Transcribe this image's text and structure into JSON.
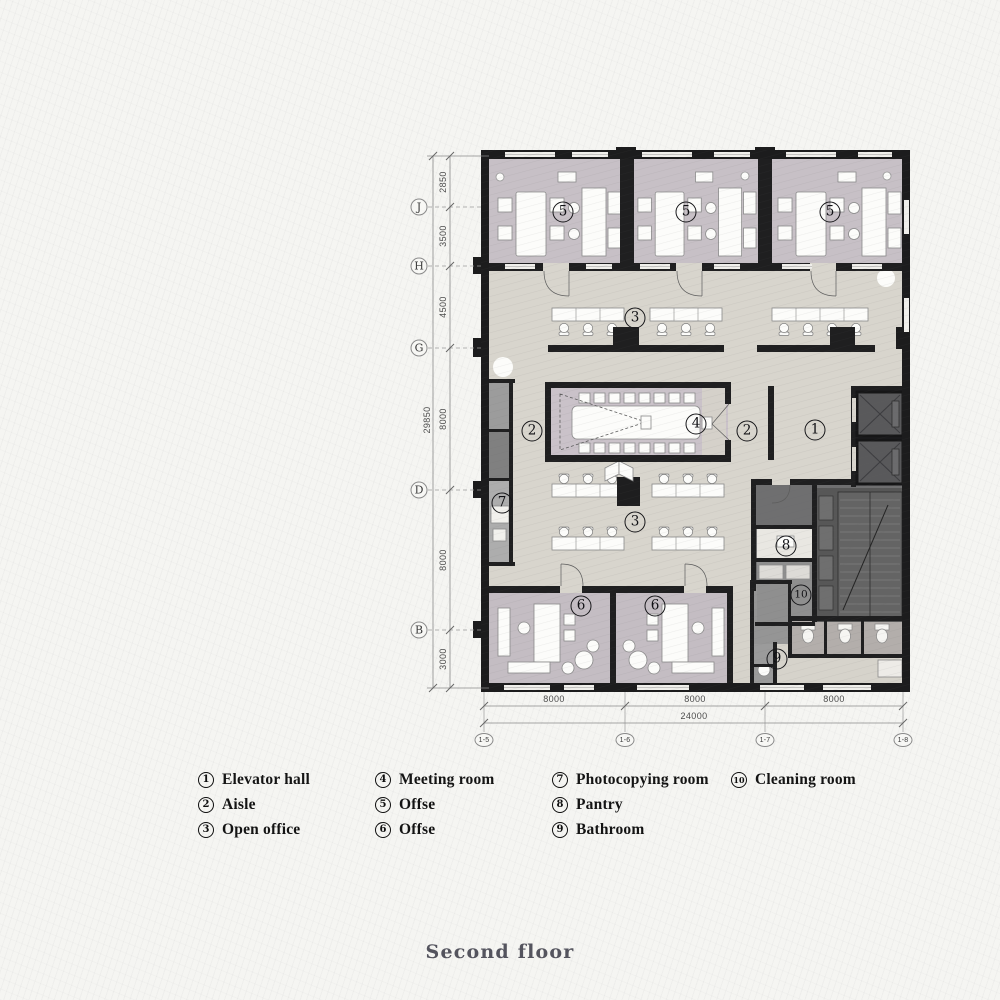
{
  "title": {
    "text": "Second floor"
  },
  "legend": {
    "columns": [
      [
        {
          "n": "1",
          "label": "Elevator hall"
        },
        {
          "n": "2",
          "label": "Aisle"
        },
        {
          "n": "3",
          "label": "Open office"
        }
      ],
      [
        {
          "n": "4",
          "label": "Meeting room"
        },
        {
          "n": "5",
          "label": "Offse"
        },
        {
          "n": "6",
          "label": "Offse"
        }
      ],
      [
        {
          "n": "7",
          "label": "Photocopying room"
        },
        {
          "n": "8",
          "label": "Pantry"
        },
        {
          "n": "9",
          "label": "Bathroom"
        }
      ],
      [
        {
          "n": "10",
          "label": "Cleaning room"
        }
      ]
    ]
  },
  "plan": {
    "room_labels": [
      {
        "n": "5",
        "x": 563,
        "y": 212
      },
      {
        "n": "5",
        "x": 686,
        "y": 212
      },
      {
        "n": "5",
        "x": 830,
        "y": 212
      },
      {
        "n": "3",
        "x": 635,
        "y": 318
      },
      {
        "n": "2",
        "x": 532,
        "y": 431
      },
      {
        "n": "4",
        "x": 696,
        "y": 424
      },
      {
        "n": "2",
        "x": 747,
        "y": 431
      },
      {
        "n": "1",
        "x": 815,
        "y": 430
      },
      {
        "n": "7",
        "x": 502,
        "y": 503
      },
      {
        "n": "3",
        "x": 635,
        "y": 522
      },
      {
        "n": "8",
        "x": 786,
        "y": 546
      },
      {
        "n": "10",
        "x": 801,
        "y": 595
      },
      {
        "n": "6",
        "x": 581,
        "y": 606
      },
      {
        "n": "6",
        "x": 655,
        "y": 606
      },
      {
        "n": "9",
        "x": 777,
        "y": 659
      }
    ],
    "grid_rows": [
      {
        "label": "J",
        "y": 207
      },
      {
        "label": "H",
        "y": 266
      },
      {
        "label": "G",
        "y": 348
      },
      {
        "label": "D",
        "y": 490
      },
      {
        "label": "B",
        "y": 630
      }
    ],
    "grid_cols": [
      {
        "label": "1-5",
        "x": 484
      },
      {
        "label": "1-6",
        "x": 625
      },
      {
        "label": "1-7",
        "x": 765
      },
      {
        "label": "1-8",
        "x": 903
      }
    ],
    "dims_left": {
      "segments": [
        {
          "value": "2850",
          "y": 182
        },
        {
          "value": "3500",
          "y": 236
        },
        {
          "value": "4500",
          "y": 307
        },
        {
          "value": "8000",
          "y": 419
        },
        {
          "value": "8000",
          "y": 560
        },
        {
          "value": "3000",
          "y": 659
        }
      ],
      "total": {
        "value": "29850",
        "y": 420
      }
    },
    "dims_bottom": {
      "segments": [
        {
          "value": "8000",
          "x": 554
        },
        {
          "value": "8000",
          "x": 695
        },
        {
          "value": "8000",
          "x": 834
        }
      ],
      "total": {
        "value": "24000",
        "x": 694
      }
    }
  },
  "colors": {
    "wall": "#1f1f20",
    "floor_main": "#d8d5cd",
    "floor_office": "#c7c0c6",
    "floor_meeting": "#cac2c9",
    "service_dark": "#6f6f70",
    "stairs": "#575757",
    "paper": "#f5f5f2"
  }
}
